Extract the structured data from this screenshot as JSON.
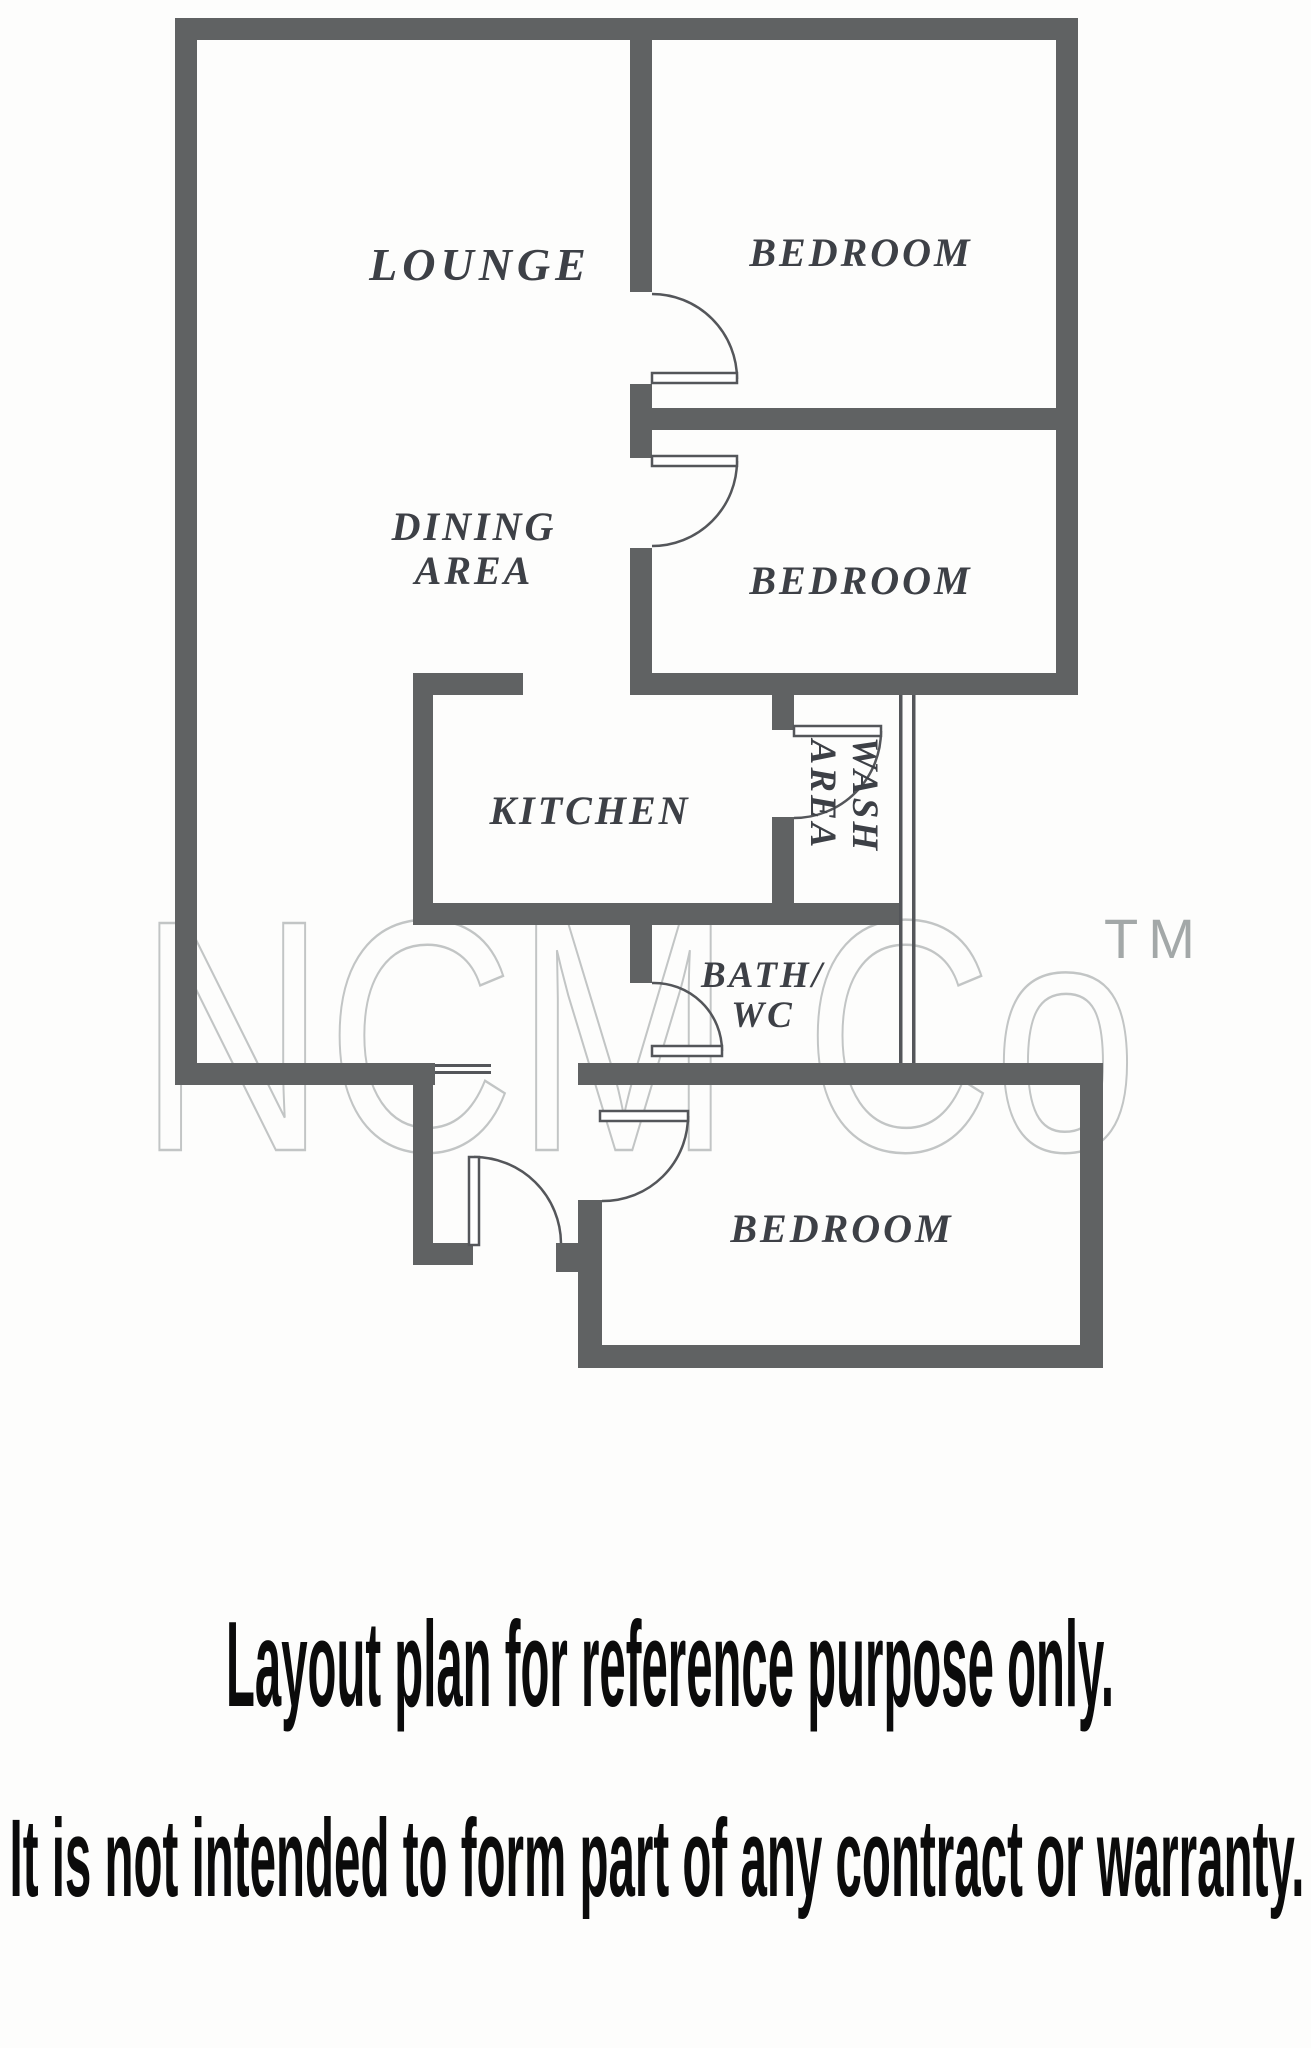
{
  "page": {
    "background": "#fdfdfc"
  },
  "floor_plan": {
    "wall_color": "#606263",
    "line_color": "#54565a",
    "label_color": "#3d4046",
    "rooms": {
      "lounge": "LOUNGE",
      "bedroom_top": "BEDROOM",
      "bedroom_middle": "BEDROOM",
      "bedroom_bottom": "BEDROOM",
      "dining_line1": "DINING",
      "dining_line2": "AREA",
      "kitchen": "KITCHEN",
      "wash_line1": "WASH",
      "wash_line2": "AREA",
      "bath_line1": "BATH/",
      "bath_line2": "WC"
    },
    "watermark": {
      "text": "NCM Co",
      "tm": "TM",
      "outline_color": "#c2c5c5",
      "tm_color": "#a3a8a8"
    }
  },
  "captions": {
    "line1": "Layout plan for reference purpose only.",
    "line2": "It is not intended to form part of any contract or warranty.",
    "color": "#0b0b0b"
  }
}
